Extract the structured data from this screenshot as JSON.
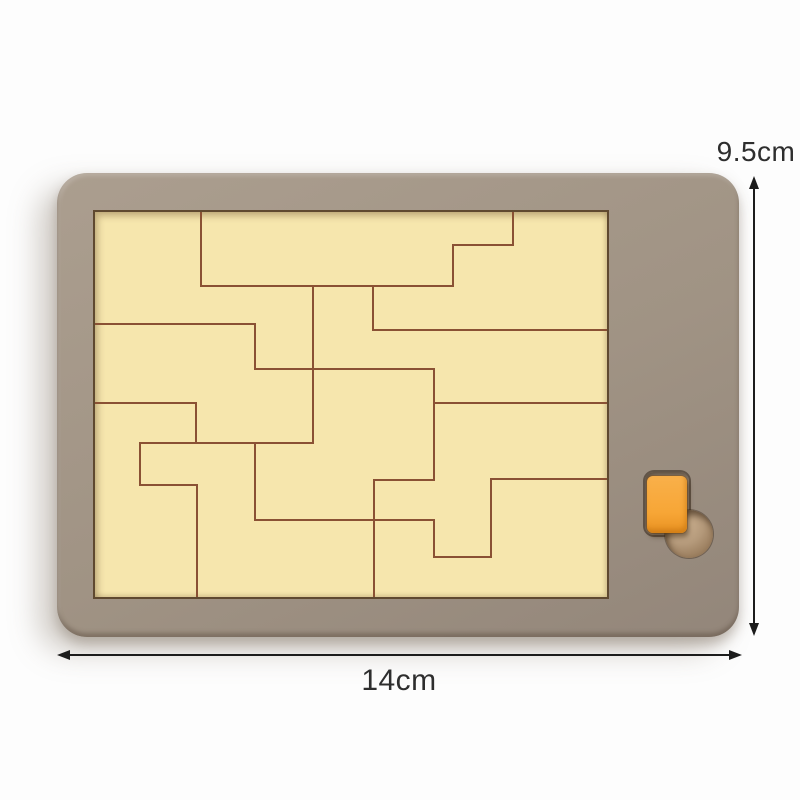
{
  "image": {
    "type": "product-photo",
    "subject": "wooden tetromino puzzle tray with orange piece slot"
  },
  "annotations": {
    "height_label": "9.5cm",
    "width_label": "14cm"
  },
  "colors": {
    "bg": "#fdfdfd",
    "frame-light": "#ab9e8f",
    "frame": "#a09384",
    "frame-dark": "#93867a",
    "tray": "#f6e6ad",
    "tray-edge": "#5f4930",
    "line": "#8a5134",
    "recess": "#8e8071",
    "hole": "#b4997a",
    "piece": "#f7a636",
    "piece-dark": "#e89122",
    "arrow": "#1c1c1c",
    "text": "#2e2e2e"
  },
  "puzzle": {
    "viewbox": "0 0 512 385",
    "segments": [
      [
        106,
        0,
        106,
        74
      ],
      [
        106,
        74,
        358,
        74
      ],
      [
        218,
        74,
        218,
        231
      ],
      [
        0,
        112,
        160,
        112
      ],
      [
        160,
        112,
        160,
        157
      ],
      [
        160,
        157,
        339,
        157
      ],
      [
        339,
        157,
        339,
        268
      ],
      [
        45,
        231,
        218,
        231
      ],
      [
        45,
        231,
        45,
        273
      ],
      [
        45,
        273,
        102,
        273
      ],
      [
        102,
        273,
        102,
        385
      ],
      [
        0,
        191,
        101,
        191
      ],
      [
        101,
        191,
        101,
        231
      ],
      [
        358,
        33,
        418,
        33
      ],
      [
        358,
        33,
        358,
        74
      ],
      [
        418,
        0,
        418,
        33
      ],
      [
        278,
        74,
        278,
        118
      ],
      [
        278,
        118,
        512,
        118
      ],
      [
        339,
        191,
        512,
        191
      ],
      [
        160,
        231,
        160,
        308
      ],
      [
        160,
        308,
        339,
        308
      ],
      [
        279,
        268,
        339,
        268
      ],
      [
        279,
        268,
        279,
        385
      ],
      [
        339,
        308,
        339,
        345
      ],
      [
        339,
        345,
        396,
        345
      ],
      [
        396,
        267,
        396,
        345
      ],
      [
        396,
        267,
        512,
        267
      ]
    ]
  }
}
